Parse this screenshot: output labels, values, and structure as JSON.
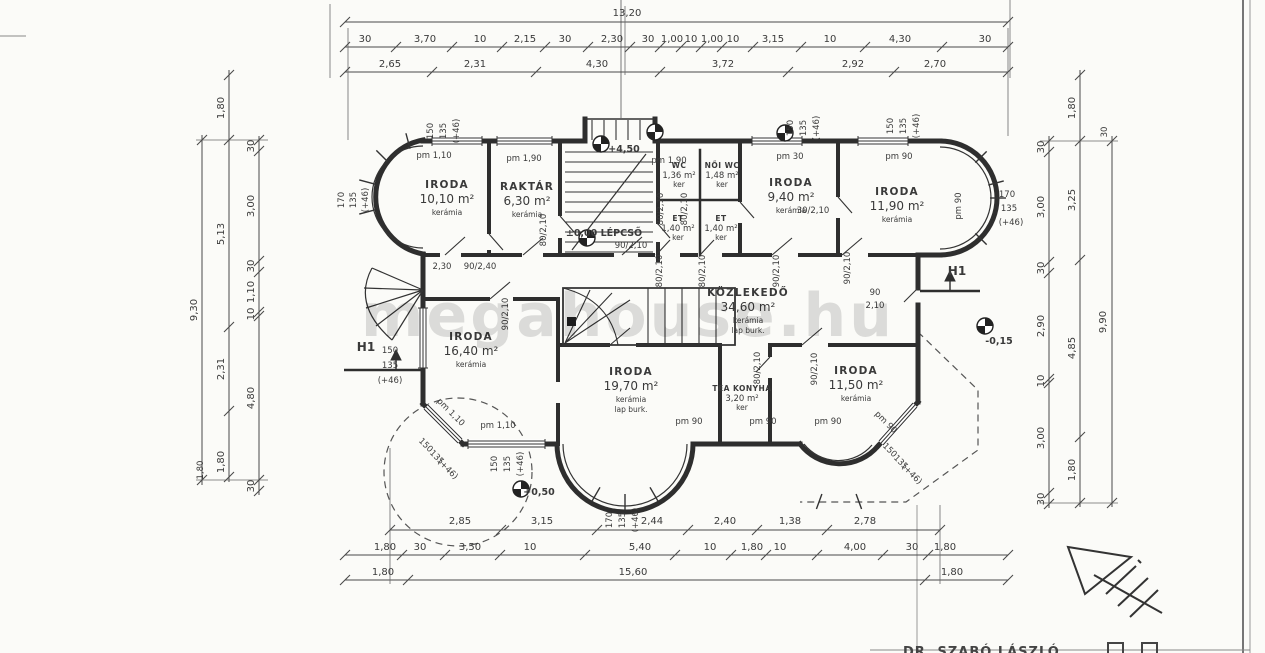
{
  "watermark": "megahouse.hu",
  "credit": "DR. SZABÓ LÁSZLÓ",
  "marks": {
    "h1_left": "H1",
    "h1_right": "H1"
  },
  "levels": {
    "entry": "±0,00 LÉPCSŐ",
    "upper": "+4,50",
    "terrace_right": "-0,15",
    "terrace_bottom": "+0,50"
  },
  "rooms": [
    {
      "name": "IRODA",
      "area": "10,10 m²",
      "finish": "kerámia"
    },
    {
      "name": "RAKTÁR",
      "area": "6,30 m²",
      "finish": "kerámia"
    },
    {
      "name": "WC",
      "area": "1,36 m²",
      "finish": "ker"
    },
    {
      "name": "NŐI WC",
      "area": "1,48 m²",
      "finish": "ker"
    },
    {
      "name": "ET",
      "area": "1,40 m²",
      "finish": "ker"
    },
    {
      "name": "ET",
      "area": "1,40 m²",
      "finish": "ker"
    },
    {
      "name": "IRODA",
      "area": "9,40 m²",
      "finish": "kerámia"
    },
    {
      "name": "IRODA",
      "area": "11,90 m²",
      "finish": "kerámia"
    },
    {
      "name": "KÖZLEKEDŐ",
      "area": "34,60 m²",
      "finish": "kerámia",
      "finish2": "lap burk."
    },
    {
      "name": "IRODA",
      "area": "16,40 m²",
      "finish": "kerámia"
    },
    {
      "name": "IRODA",
      "area": "19,70 m²",
      "finish": "kerámia",
      "finish2": "lap burk."
    },
    {
      "name": "TEA KONYHA",
      "area": "3,20 m²",
      "finish": "ker"
    },
    {
      "name": "IRODA",
      "area": "11,50 m²",
      "finish": "kerámia"
    }
  ],
  "dims": {
    "top_total": "13,20",
    "top_row2": [
      "30",
      "3,70",
      "10",
      "2,15",
      "30",
      "2,30",
      "30",
      "1,00",
      "10",
      "1,00",
      "10",
      "3,15",
      "10",
      "4,30",
      "30"
    ],
    "top_row3": [
      "2,65",
      "2,31",
      "4,30",
      "3,72",
      "2,92",
      "2,70"
    ],
    "bottom_row1": [
      "2,85",
      "3,15",
      "2,44",
      "2,40",
      "1,38",
      "2,78"
    ],
    "bottom_row2": [
      "1,80",
      "30",
      "3,50",
      "10",
      "5,40",
      "10",
      "1,80",
      "10",
      "4,00",
      "30",
      "1,80"
    ],
    "bottom_row3": [
      "1,80",
      "15,60",
      "1,80"
    ],
    "left_inner": [
      "30",
      "3,00",
      "30",
      "1,10",
      "10",
      "4,80",
      "30"
    ],
    "left_mid": [
      "1,80",
      "5,13",
      "2,31",
      "1,80"
    ],
    "left_outer": "9,30",
    "right_inner": [
      "30",
      "3,00",
      "30",
      "2,90",
      "10",
      "3,00",
      "30"
    ],
    "right_mid": [
      "1,80",
      "3,25",
      "4,85",
      "1,80"
    ],
    "right_outer": "9,90"
  },
  "annotations": [
    "150",
    "135",
    "(+46)",
    "150",
    "135",
    "(+46)",
    "150",
    "135",
    "(+46)",
    "170",
    "135",
    "(+46)",
    "170",
    "135",
    "(+46)",
    "150",
    "135",
    "(+46)",
    "150",
    "135",
    "(+46)",
    "150",
    "135",
    "(+46)",
    "170",
    "135",
    "(+46)",
    "150",
    "135",
    "(+46)",
    "pm 1,10",
    "pm 1,90",
    "pm 1,90",
    "pm 30",
    "pm 90",
    "pm 90",
    "pm 1,10",
    "pm 90",
    "pm 90",
    "pm 90",
    "pm 1,10",
    "pm 90",
    "2,30",
    "90/2,40",
    "80/2,10",
    "90/2,10",
    "80/2,10",
    "80/2,10",
    "80/2,10",
    "80/2,10",
    "90/2,10",
    "90/2,10",
    "30/2,10",
    "90/2,10",
    "80/2,10",
    "90/2,10",
    "90",
    "2,10",
    "1,80",
    "30"
  ]
}
